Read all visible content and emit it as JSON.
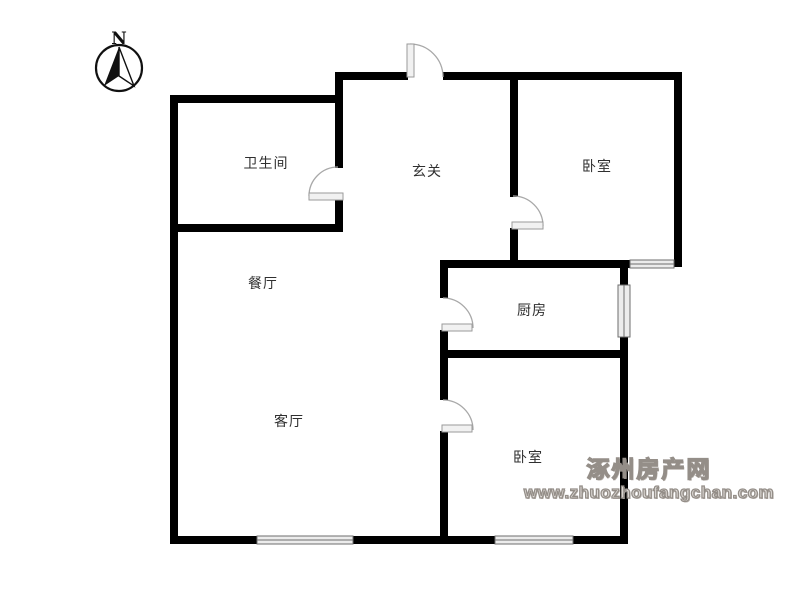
{
  "page": {
    "background": "#ffffff"
  },
  "compass": {
    "label": "N"
  },
  "rooms": [
    {
      "id": "bathroom",
      "label": "卫生间",
      "x": 266,
      "y": 163
    },
    {
      "id": "entry-hall",
      "label": "玄关",
      "x": 427,
      "y": 171
    },
    {
      "id": "bedroom-north",
      "label": "卧室",
      "x": 597,
      "y": 166
    },
    {
      "id": "dining-room",
      "label": "餐厅",
      "x": 263,
      "y": 283
    },
    {
      "id": "kitchen",
      "label": "厨房",
      "x": 532,
      "y": 310
    },
    {
      "id": "living-room",
      "label": "客厅",
      "x": 289,
      "y": 421
    },
    {
      "id": "bedroom-south",
      "label": "卧室",
      "x": 528,
      "y": 457
    }
  ],
  "watermark": {
    "site_name": "涿州房产网",
    "site_url": "www.zhuozhoufangchan.com"
  },
  "colors": {
    "wall": "#000000",
    "window_fill": "#ececec",
    "window_edge": "#6e6e6e",
    "door_leaf_fill": "#f1f1f1",
    "door_leaf_edge": "#9a9a9a",
    "door_arc": "#a8a8a8",
    "compass": "#111111",
    "label": "#2f2f2f",
    "watermark_stroke": "#948e88",
    "watermark_fill": "#dedad6"
  },
  "floorplan": {
    "canvas": {
      "width": 800,
      "height": 600
    },
    "wall_thickness": 8,
    "walls": [
      [
        170,
        95,
        8,
        448
      ],
      [
        170,
        95,
        173,
        8
      ],
      [
        335,
        72,
        8,
        96
      ],
      [
        335,
        199,
        8,
        33
      ],
      [
        170,
        224,
        173,
        8
      ],
      [
        335,
        72,
        73,
        8
      ],
      [
        443,
        72,
        239,
        8
      ],
      [
        510,
        72,
        8,
        125
      ],
      [
        510,
        228,
        8,
        40
      ],
      [
        674,
        72,
        8,
        195
      ],
      [
        440,
        260,
        190,
        8
      ],
      [
        440,
        260,
        8,
        38
      ],
      [
        440,
        330,
        8,
        28
      ],
      [
        440,
        350,
        188,
        8
      ],
      [
        620,
        260,
        8,
        25
      ],
      [
        620,
        337,
        8,
        207
      ],
      [
        440,
        358,
        8,
        42
      ],
      [
        440,
        431,
        8,
        113
      ],
      [
        170,
        536,
        87,
        8
      ],
      [
        353,
        536,
        142,
        8
      ],
      [
        573,
        536,
        55,
        8
      ]
    ],
    "windows": [
      {
        "name": "living-room-window",
        "rect": [
          257,
          536,
          96,
          8
        ],
        "orient": "h"
      },
      {
        "name": "bedroom-south-window",
        "rect": [
          495,
          536,
          78,
          8
        ],
        "orient": "h"
      },
      {
        "name": "kitchen-window",
        "rect": [
          618,
          285,
          12,
          52
        ],
        "orient": "v"
      },
      {
        "name": "bedroom-north-window",
        "rect": [
          630,
          260,
          44,
          8
        ],
        "orient": "h"
      }
    ],
    "doors": [
      {
        "name": "entrance-door",
        "leaf": [
          407,
          44,
          7,
          33
        ],
        "arc": "M 410 44 A 33 33 0 0 1 443 77"
      },
      {
        "name": "bathroom-door",
        "leaf": [
          309,
          193,
          34,
          7
        ],
        "arc": "M 309 196 A 29 29 0 0 1 338 167"
      },
      {
        "name": "bedroom-north-door",
        "leaf": [
          512,
          222,
          31,
          7
        ],
        "arc": "M 513 196 A 30 30 0 0 1 543 226"
      },
      {
        "name": "kitchen-door",
        "leaf": [
          442,
          324,
          30,
          7
        ],
        "arc": "M 443 298 A 30 30 0 0 1 473 328"
      },
      {
        "name": "bedroom-south-door",
        "leaf": [
          442,
          425,
          30,
          7
        ],
        "arc": "M 443 400 A 30 30 0 0 1 473 430"
      }
    ]
  }
}
